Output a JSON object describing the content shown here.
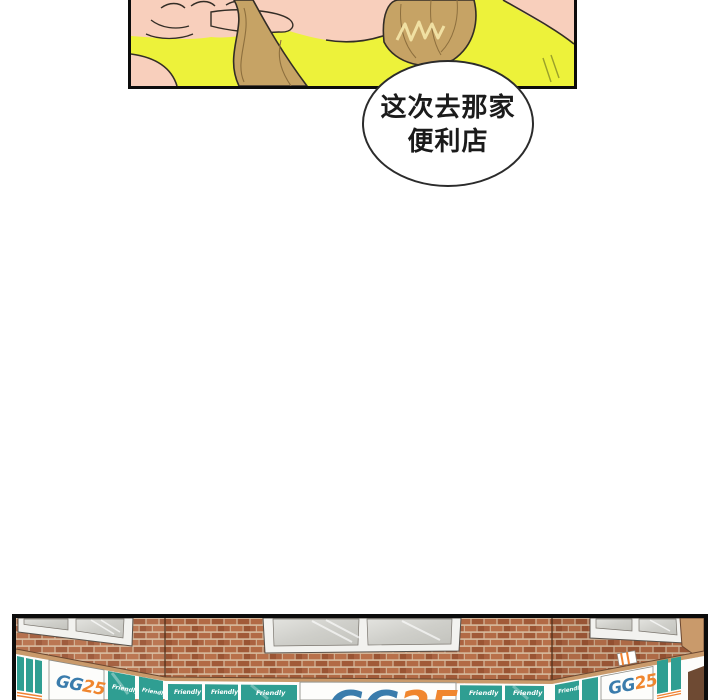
{
  "page": {
    "background_color": "#ffffff",
    "kind": "webtoon-comic-page"
  },
  "speech_bubble": {
    "line1": "这次去那家",
    "line2": "便利店",
    "text_color": "#1b1b1b",
    "fill": "#ffffff",
    "stroke": "#2b2b2b"
  },
  "top_panel": {
    "description_colors": {
      "shirt_yellow": "#edf23a",
      "skin": "#f8cfbc",
      "hair": "#c6a365",
      "hair_shadow": "#8d6f3e",
      "hair_highlight": "#f2e4a6",
      "outline": "#332d26",
      "panel_border": "#0c0c0c"
    }
  },
  "bottom_panel": {
    "store_signs": {
      "logo_gg": "GG",
      "logo_25": "25",
      "friendly_label": "Friendly"
    },
    "description_colors": {
      "brick": "#b26a45",
      "mortar": "#d7bb9e",
      "sign_teal": "#2f9e92",
      "logo_blue": "#3a7cac",
      "logo_orange": "#f0862e",
      "stripe_orange": "#f08232",
      "window_frame": "#f2f2ef",
      "window_glass": "#d8d8d3",
      "trim_tan": "#c99a6b",
      "corner_brown": "#6e4a33",
      "panel_border": "#0c0c0c"
    }
  }
}
